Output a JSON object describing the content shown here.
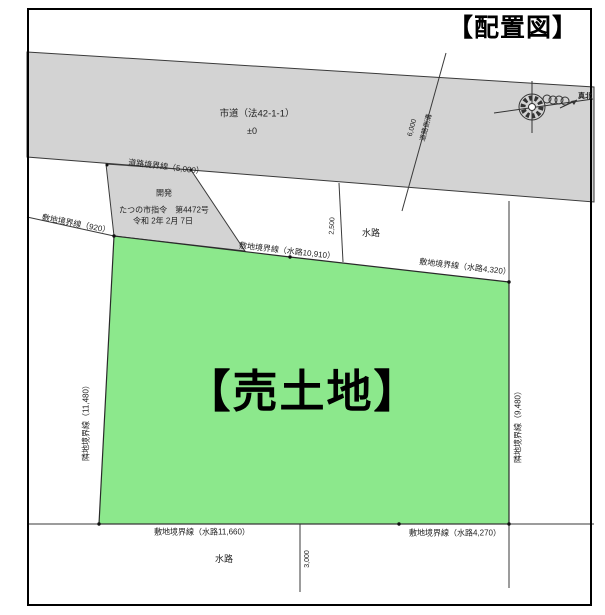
{
  "title": "【配置図】",
  "compass": {
    "north_label": "真北"
  },
  "road": {
    "name": "市道（法42-1-1）",
    "elevation": "±0",
    "boundary_label": "道路境界線（5,000）",
    "gutter_dim": "6,000",
    "gutter_label": "道路側溝"
  },
  "permit": {
    "line1": "開発",
    "line2": "たつの市指令　第4472号",
    "line3": "令和 2年 2月 7日"
  },
  "plot": {
    "label": "【売土地】"
  },
  "boundaries": {
    "top_left": "敷地境界線（920）",
    "top_mid": "敷地境界線（水路10,910）",
    "top_right": "敷地境界線（水路4,320）",
    "left": "隣地境界線（11,480）",
    "right": "隣地境界線（9,480）",
    "bottom_left": "敷地境界線（水路11,660）",
    "bottom_right": "敷地境界線（水路4,270）"
  },
  "waterway": {
    "top_label": "水路",
    "top_dim": "2,500",
    "bottom_label": "水路",
    "bottom_dim": "3,000"
  },
  "colors": {
    "road_gray": "#d3d3d3",
    "plot_green": "#8ce88c",
    "line": "#3a3a3a",
    "frame": "#000000"
  }
}
